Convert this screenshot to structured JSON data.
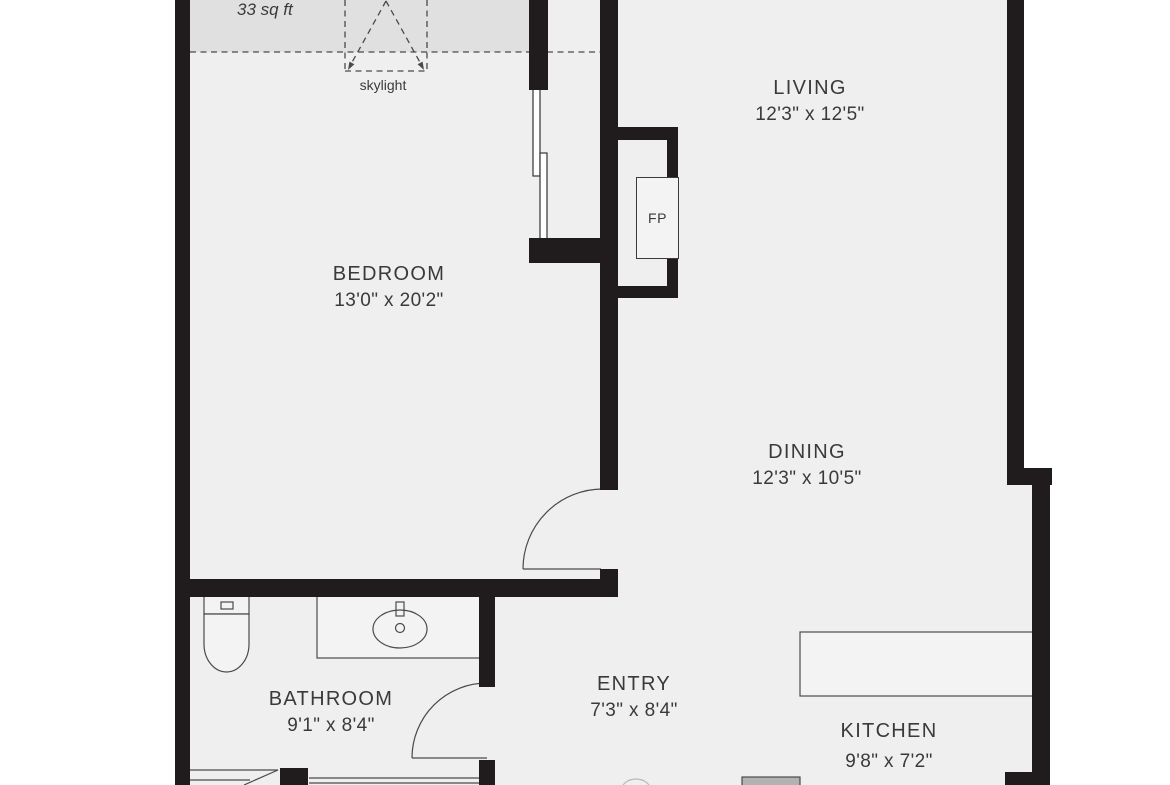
{
  "plan": {
    "rooms": [
      {
        "name": "LIVING",
        "dims": "12'3\" x 12'5\""
      },
      {
        "name": "BEDROOM",
        "dims": "13'0\" x 20'2\""
      },
      {
        "name": "DINING",
        "dims": "12'3\" x 10'5\""
      },
      {
        "name": "BATHROOM",
        "dims": "9'1\" x 8'4\""
      },
      {
        "name": "ENTRY",
        "dims": "7'3\" x 8'4\""
      },
      {
        "name": "KITCHEN",
        "dims": "9'8\" x 7'2\""
      }
    ],
    "annotations": {
      "skylight_area": "33 sq ft",
      "skylight": "skylight",
      "fireplace": "FP"
    },
    "colors": {
      "wall": "#201c1d",
      "floor": "#f0eff0",
      "skylight_band": "#e1e0e1",
      "line": "#4a4a4a",
      "text": "#3a3a3a",
      "background": "#ffffff"
    }
  }
}
